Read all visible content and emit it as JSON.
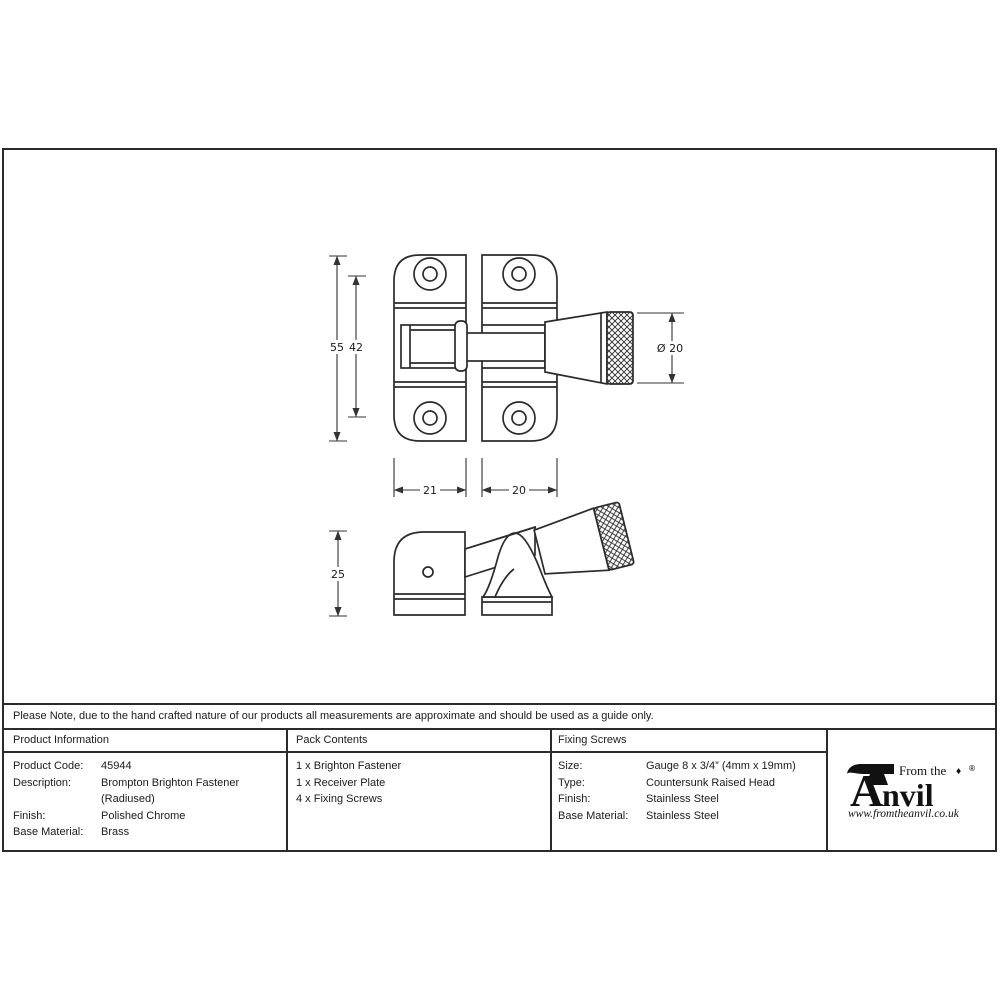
{
  "colors": {
    "ink": "#2b2b2b"
  },
  "drawing": {
    "front_view": {
      "overall_height": "55",
      "hole_spacing_height": "42",
      "plate_width": "21",
      "receiver_width": "20",
      "knob_diameter": "Ø 20"
    },
    "side_view": {
      "depth": "25"
    }
  },
  "note": "Please Note, due to the hand crafted nature of our products all measurements are approximate and should be used as a guide only.",
  "table": {
    "product_information": {
      "header": "Product Information",
      "rows": [
        {
          "label": "Product Code:",
          "value": "45944"
        },
        {
          "label": "Description:",
          "value": "Brompton Brighton Fastener (Radiused)"
        },
        {
          "label": "Finish:",
          "value": "Polished Chrome"
        },
        {
          "label": "Base Material:",
          "value": "Brass"
        }
      ]
    },
    "pack_contents": {
      "header": "Pack Contents",
      "items": [
        "1 x Brighton Fastener",
        "1 x Receiver Plate",
        "4 x Fixing Screws"
      ]
    },
    "fixing_screws": {
      "header": "Fixing Screws",
      "rows": [
        {
          "label": "Size:",
          "value": "Gauge 8 x 3/4” (4mm x 19mm)"
        },
        {
          "label": "Type:",
          "value": "Countersunk Raised Head"
        },
        {
          "label": "Finish:",
          "value": "Stainless Steel"
        },
        {
          "label": "Base Material:",
          "value": "Stainless Steel"
        }
      ]
    }
  },
  "logo": {
    "tagline": "From the",
    "name_initial": "A",
    "name_rest": "nvil",
    "ornament": "♦",
    "registered": "®",
    "website": "www.fromtheanvil.co.uk"
  }
}
